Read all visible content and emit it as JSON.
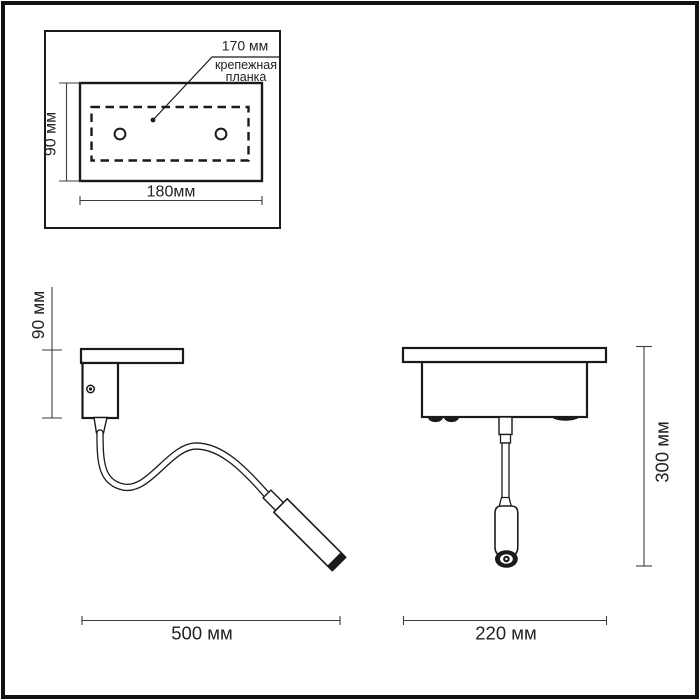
{
  "colors": {
    "line": "#1a1a1a",
    "dim": "#3d3d3d",
    "text": "#222222",
    "background": "#ffffff",
    "frame": "#111111"
  },
  "inset": {
    "callout_value": "170 мм",
    "callout_label_line1": "крепежная",
    "callout_label_line2": "планка",
    "height_label": "90 мм",
    "width_label": "180мм"
  },
  "side_view": {
    "height_label": "90 мм",
    "width_label": "500 мм"
  },
  "front_view": {
    "height_label": "300 мм",
    "width_label": "220 мм"
  }
}
